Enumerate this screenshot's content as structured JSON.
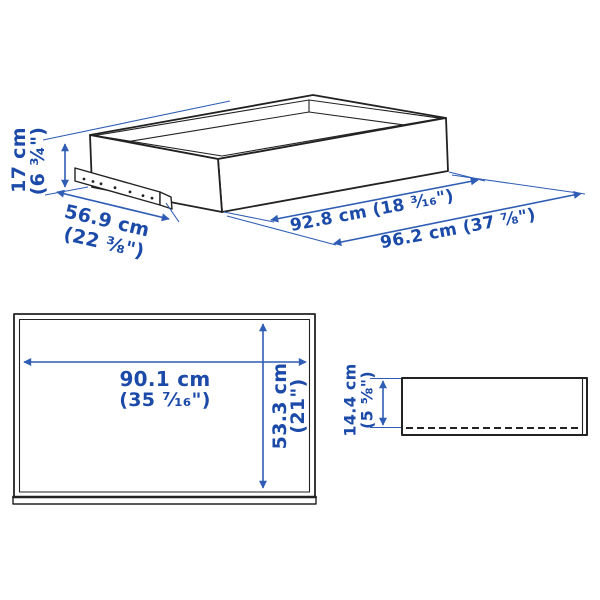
{
  "colors": {
    "text_blue": "#1b4aa8",
    "line_blue": "#2f5db5",
    "ink": "#222222",
    "background": "#ffffff"
  },
  "iso_view": {
    "height_cm": "17 cm",
    "height_in": "(6 ¾\")",
    "depth_cm": "56.9 cm",
    "depth_in": "(22 ⅜\")",
    "front_width_label": "92.8 cm (18 ³⁄₁₆\")",
    "total_width_label": "96.2 cm (37 ⅞\")"
  },
  "front_view": {
    "width_cm": "90.1 cm",
    "width_in": "(35 ⁷⁄₁₆\")",
    "height_cm": "53.3 cm",
    "height_in": "(21\")"
  },
  "side_view": {
    "height_cm": "14.4 cm",
    "height_in": "(5 ⅝\")"
  }
}
